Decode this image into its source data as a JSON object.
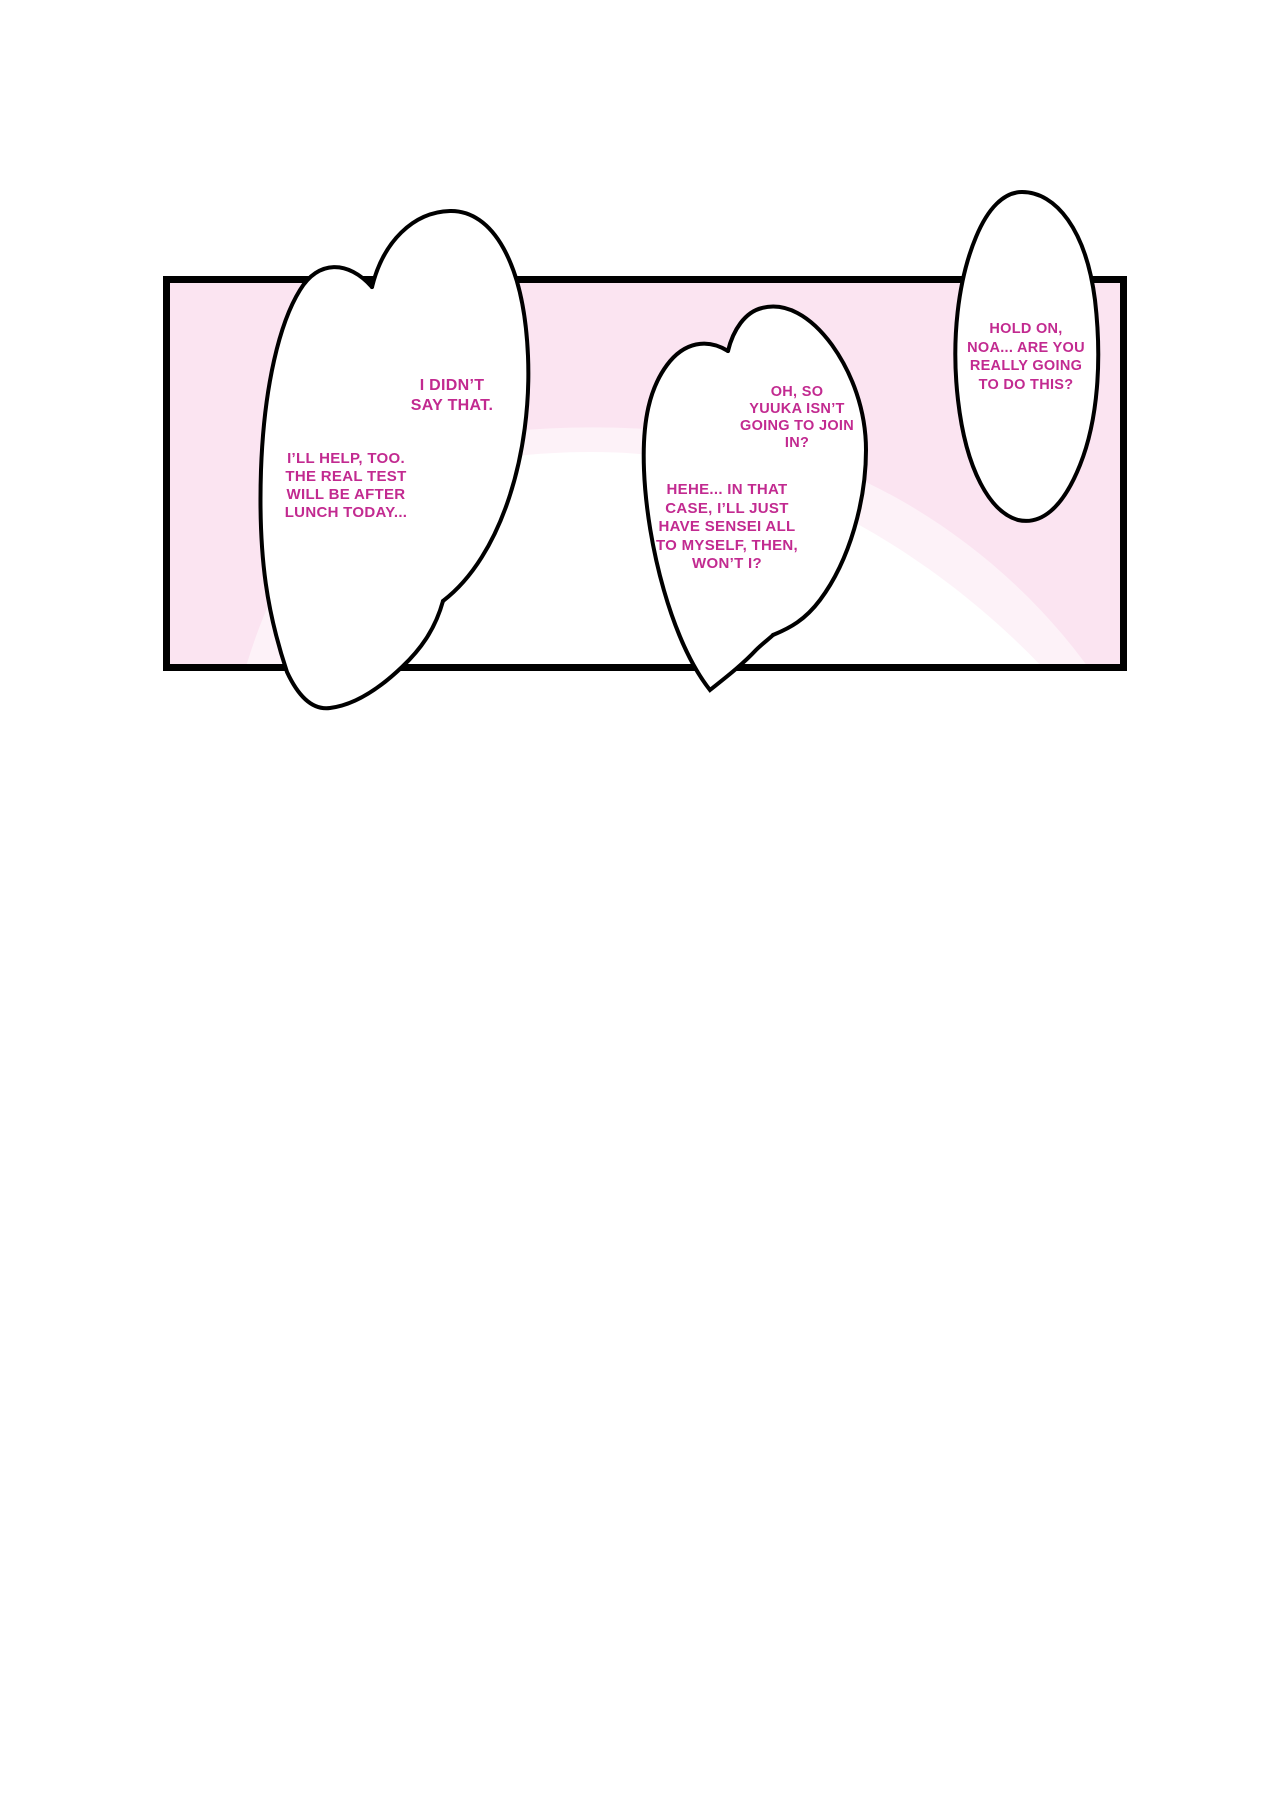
{
  "page": {
    "kind": "comic-page-panel",
    "description": "Single manga panel with pink background and five lines of dialogue in merged white speech bubbles"
  },
  "colors": {
    "page_background": "#ffffff",
    "panel_fill": "#fbe4f1",
    "panel_fill_light_blob": "#fdf2f8",
    "panel_blob_white": "#ffffff",
    "outline": "#000000",
    "dialogue_text": "#c22a90"
  },
  "bubbles": [
    {
      "name": "bubble-i-didnt-say-that",
      "lines": [
        "I DIDN’T",
        "SAY THAT."
      ]
    },
    {
      "name": "bubble-ill-help-too",
      "lines": [
        "I’LL HELP, TOO.",
        "THE REAL TEST",
        "WILL BE AFTER",
        "LUNCH TODAY..."
      ]
    },
    {
      "name": "bubble-oh-so-yuuka",
      "lines": [
        "OH, SO",
        "YUUKA ISN’T",
        "GOING TO JOIN",
        "IN?"
      ]
    },
    {
      "name": "bubble-hehe-in-that-case",
      "lines": [
        "HEHE... IN THAT",
        "CASE, I’LL JUST",
        "HAVE SENSEI ALL",
        "TO MYSELF, THEN,",
        "WON’T I?"
      ]
    },
    {
      "name": "bubble-hold-on-noa",
      "lines": [
        "HOLD ON,",
        "NOA... ARE YOU",
        "REALLY GOING",
        "TO DO THIS?"
      ]
    }
  ]
}
